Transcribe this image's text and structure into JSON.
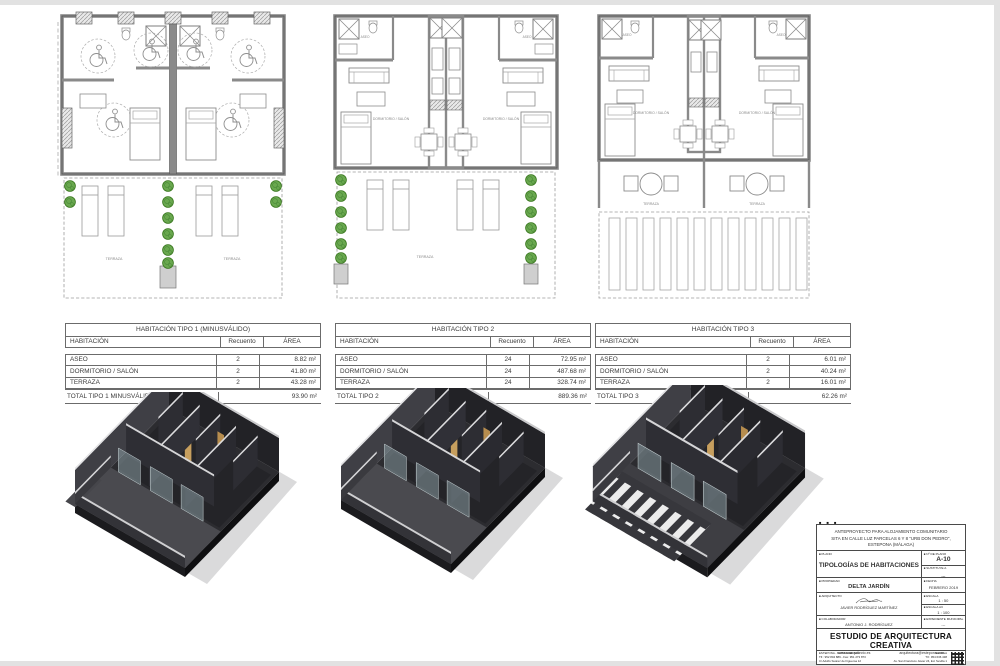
{
  "plan_labels": {
    "terraza": "TERRAZA",
    "dormitorio": "DORMITORIO / SALÓN",
    "aseo": "ASEO"
  },
  "tables": [
    {
      "title": "HABITACIÓN TIPO 1 (MINUSVÁLIDO)",
      "columns": [
        "HABITACIÓN",
        "Recuento",
        "ÁREA"
      ],
      "rows": [
        [
          "ASEO",
          "2",
          "8.82 m²"
        ],
        [
          "DORMITORIO / SALÓN",
          "2",
          "41.80 m²"
        ],
        [
          "TERRAZA",
          "2",
          "43.28 m²"
        ]
      ],
      "total_label": "TOTAL TIPO 1 MINUSVÁLIDO",
      "total_area": "93.90 m²"
    },
    {
      "title": "HABITACIÓN TIPO 2",
      "columns": [
        "HABITACIÓN",
        "Recuento",
        "ÁREA"
      ],
      "rows": [
        [
          "ASEO",
          "24",
          "72.95 m²"
        ],
        [
          "DORMITORIO / SALÓN",
          "24",
          "487.68 m²"
        ],
        [
          "TERRAZA",
          "24",
          "328.74 m²"
        ]
      ],
      "total_label": "TOTAL TIPO 2",
      "total_area": "889.36 m²"
    },
    {
      "title": "HABITACIÓN TIPO 3",
      "columns": [
        "HABITACIÓN",
        "Recuento",
        "ÁREA"
      ],
      "rows": [
        [
          "ASEO",
          "2",
          "6.01 m²"
        ],
        [
          "DORMITORIO / SALÓN",
          "2",
          "40.24 m²"
        ],
        [
          "TERRAZA",
          "2",
          "16.01 m²"
        ]
      ],
      "total_label": "TOTAL TIPO 3",
      "total_area": "62.26 m²"
    }
  ],
  "titleblock": {
    "project_line1": "ANTEPROYECTO PARA ALOJAMIENTO COMUNITARIO",
    "project_line2": "SITA EN CALLE LUZ PARCELAS 6 Y 8 \"URB DON PEDRO\",",
    "project_line3": "ESTEPONA (MÁLAGA)",
    "plano_label": "PLANO",
    "plano": "TIPOLOGÍAS DE HABITACIONES",
    "num_label": "Nº DE PLANO",
    "num": "A-10",
    "sustituye_label": "SUSTITUYE A",
    "sustituye": "---",
    "propiedad_label": "PROPIEDAD",
    "propiedad": "DELTA JARDÍN",
    "fecha_label": "FECHA",
    "fecha": "FEBRERO 2019",
    "arquitecto_label": "ARQUITECTO",
    "arquitecto": "JAVIER RODRÍGUEZ MARTÍNEZ",
    "escala_label": "ESCALA",
    "escala": "1 : 50",
    "escala_a3_label": "ESCALA A3",
    "escala_a3": "1 : 100",
    "colaborador_label": "COLABORADOR",
    "colaborador": "ANTONIO J. RODRÍGUEZ",
    "expediente_label": "EXPEDIENTE MUNICIPAL",
    "expediente": "---",
    "firm": "ESTUDIO DE ARQUITECTURA CREATIVA",
    "web1": "www.suarquitecto.es",
    "web2": "arquitectura@estepona.com",
    "office1": [
      "ESTEPONA - COSTA DEL SOL",
      "Tlf.: 952 804 889 - Fax: 951 273 873",
      "C/ Adolfo Suárez de Figueroa 12"
    ],
    "office2": [
      "SEVILLA",
      "Tlf.: 954 636 438",
      "Av. San Francisco Javier 24, Ed. Sevilla 1"
    ]
  },
  "colors": {
    "wall_gray": "#8a8a8a",
    "wall_dark": "#555555",
    "planter_green": "#6aa84f",
    "planter_green_dark": "#38761d",
    "axon_wall": "#2c2c30",
    "axon_door_tan": "#c79f5e",
    "axon_cap_light": "#dcdcde",
    "table_border": "#6b6b6b"
  }
}
